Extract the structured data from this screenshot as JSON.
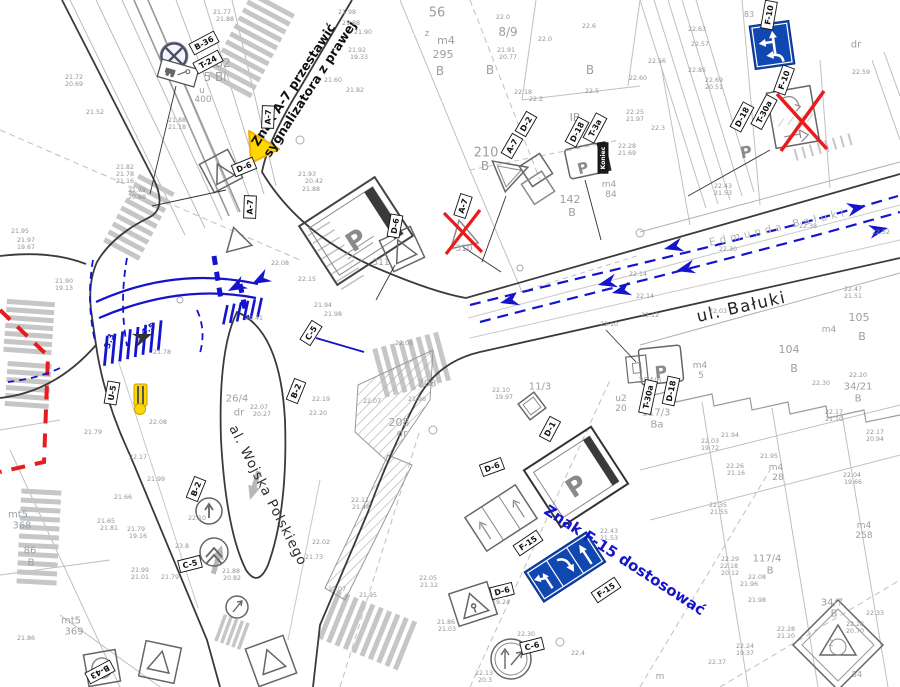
{
  "colors": {
    "marking_blue": "#1414cc",
    "sign_blue": "#1047b0",
    "alert_red": "#e81c1c",
    "temp_yellow": "#ffd800",
    "sketch_gray": "#666666",
    "cad_gray": "#b8b8b8",
    "text_gray": "#9aa0a6"
  },
  "streets": {
    "baluki": "ul. Bałuki",
    "edmunda_baluki": "Edmunda Bałuki",
    "wojska_polskiego": "al. Wojska Polskiego"
  },
  "instructions": {
    "a7_line1": "Znak A-7 przestawić",
    "a7_line2": "sygnalizatora z prawej",
    "f15": "Znak F-15 dostosować"
  },
  "sign_labels": [
    [
      204,
      43,
      "B-36",
      -28
    ],
    [
      208,
      62,
      "T-24",
      -28
    ],
    [
      268,
      117,
      "A-7",
      -88
    ],
    [
      244,
      167,
      "D-6",
      -22
    ],
    [
      250,
      207,
      "A-7",
      -88
    ],
    [
      463,
      206,
      "A-7",
      -72
    ],
    [
      512,
      146,
      "A-7",
      -60
    ],
    [
      526,
      124,
      "D-2",
      -60
    ],
    [
      577,
      132,
      "D-18",
      -62
    ],
    [
      595,
      128,
      "T-3a",
      -62
    ],
    [
      603,
      158,
      "Koniec",
      -90,
      true
    ],
    [
      742,
      117,
      "D-18",
      -62
    ],
    [
      764,
      112,
      "T-30a",
      -62
    ],
    [
      769,
      15,
      "F-10",
      -80
    ],
    [
      784,
      80,
      "F-10",
      -70
    ],
    [
      671,
      391,
      "D-18",
      -78
    ],
    [
      648,
      397,
      "T-30a",
      -78
    ],
    [
      550,
      429,
      "D-1",
      -62
    ],
    [
      395,
      226,
      "D-6",
      -80
    ],
    [
      311,
      333,
      "C-5",
      -58
    ],
    [
      296,
      391,
      "B-2",
      -68
    ],
    [
      196,
      489,
      "B-2",
      -68
    ],
    [
      190,
      564,
      "C-5",
      -14
    ],
    [
      112,
      393,
      "U-5",
      -80
    ],
    [
      492,
      467,
      "D-6",
      -20
    ],
    [
      502,
      591,
      "D-6",
      -14
    ],
    [
      532,
      646,
      "C-6",
      -14
    ],
    [
      528,
      543,
      "F-15",
      -34
    ],
    [
      606,
      590,
      "F-15",
      -34
    ],
    [
      100,
      672,
      "B-43",
      152
    ]
  ],
  "misc_labels": [
    [
      356,
      240,
      "P",
      -33,
      26,
      "#8a8a8a",
      true
    ],
    [
      576,
      486,
      "P",
      -33,
      26,
      "#8a8a8a",
      true
    ],
    [
      583,
      168,
      "P",
      -14,
      15,
      "#8a8a8a",
      true
    ],
    [
      661,
      372,
      "P",
      -6,
      17,
      "#8a8a8a",
      true
    ],
    [
      746,
      152,
      "P",
      -10,
      16,
      "#8a8a8a",
      true
    ],
    [
      109,
      341,
      "3.3",
      -70,
      8.5,
      "#1414cc",
      true
    ],
    [
      148,
      329,
      "4.5",
      -36,
      8.5,
      "#1414cc",
      true
    ]
  ],
  "parcel_labels": [
    [
      437,
      12,
      "56",
      13
    ],
    [
      427,
      33,
      "z",
      9
    ],
    [
      446,
      40,
      "m4",
      11
    ],
    [
      443,
      54,
      "295",
      11
    ],
    [
      440,
      71,
      "B",
      12
    ],
    [
      508,
      32,
      "8/9",
      12
    ],
    [
      490,
      70,
      "B",
      12
    ],
    [
      590,
      70,
      "B",
      12
    ],
    [
      223,
      63,
      "82",
      12
    ],
    [
      215,
      77,
      "5 Bi",
      12
    ],
    [
      202,
      90,
      "u",
      9
    ],
    [
      203,
      99,
      "400",
      9
    ],
    [
      575,
      117,
      "IB",
      11
    ],
    [
      486,
      152,
      "210",
      13
    ],
    [
      485,
      166,
      "B",
      12
    ],
    [
      570,
      199,
      "142",
      11
    ],
    [
      572,
      212,
      "B",
      11
    ],
    [
      609,
      184,
      "m4",
      9
    ],
    [
      611,
      194,
      "84",
      9
    ],
    [
      856,
      44,
      "dr",
      10
    ],
    [
      749,
      14,
      "83",
      8
    ],
    [
      464,
      248,
      "310",
      9
    ],
    [
      381,
      262,
      "311",
      9
    ],
    [
      427,
      383,
      "208",
      10
    ],
    [
      399,
      422,
      "208",
      11
    ],
    [
      402,
      433,
      "dr",
      10
    ],
    [
      540,
      386,
      "11/3",
      10
    ],
    [
      237,
      398,
      "26/4",
      10
    ],
    [
      239,
      412,
      "dr",
      10
    ],
    [
      789,
      349,
      "104",
      11
    ],
    [
      794,
      368,
      "B",
      11
    ],
    [
      700,
      365,
      "m4",
      9
    ],
    [
      701,
      375,
      "5",
      9
    ],
    [
      859,
      317,
      "105",
      11
    ],
    [
      829,
      329,
      "m4",
      9
    ],
    [
      862,
      336,
      "B",
      11
    ],
    [
      858,
      386,
      "34/21",
      10
    ],
    [
      858,
      398,
      "B",
      10
    ],
    [
      621,
      398,
      "u2",
      9
    ],
    [
      621,
      408,
      "20",
      9
    ],
    [
      656,
      412,
      "117/3",
      10
    ],
    [
      657,
      424,
      "Ba",
      10
    ],
    [
      650,
      380,
      "204/6",
      8
    ],
    [
      767,
      558,
      "117/4",
      10
    ],
    [
      770,
      570,
      "B",
      10
    ],
    [
      776,
      467,
      "m4",
      9
    ],
    [
      778,
      477,
      "28",
      9
    ],
    [
      864,
      525,
      "m4",
      9
    ],
    [
      864,
      535,
      "258",
      9
    ],
    [
      832,
      602,
      "34/7",
      10
    ],
    [
      834,
      613,
      "B",
      10
    ],
    [
      831,
      643,
      "2",
      9
    ],
    [
      857,
      674,
      "54",
      8
    ],
    [
      660,
      676,
      "m",
      9
    ],
    [
      18,
      514,
      "mt5",
      10
    ],
    [
      22,
      525,
      "368",
      10
    ],
    [
      30,
      550,
      "86",
      10
    ],
    [
      31,
      562,
      "B",
      10
    ],
    [
      71,
      620,
      "mt5",
      10
    ],
    [
      74,
      631,
      "369",
      10
    ]
  ],
  "elevation_labels": [
    [
      74,
      77,
      "21.72"
    ],
    [
      74,
      84,
      "20.69"
    ],
    [
      95,
      112,
      "21.52"
    ],
    [
      177,
      120,
      "21.88"
    ],
    [
      177,
      127,
      "21.18"
    ],
    [
      222,
      12,
      "21.77"
    ],
    [
      225,
      19,
      "21.88"
    ],
    [
      125,
      167,
      "21.82"
    ],
    [
      125,
      174,
      "21.78"
    ],
    [
      125,
      181,
      "21.16"
    ],
    [
      137,
      190,
      "21.79"
    ],
    [
      137,
      197,
      "20.88"
    ],
    [
      347,
      12,
      "21.98"
    ],
    [
      351,
      23,
      "21.88"
    ],
    [
      363,
      32,
      "21.90"
    ],
    [
      357,
      50,
      "21.92"
    ],
    [
      359,
      57,
      "19.33"
    ],
    [
      333,
      80,
      "21.60"
    ],
    [
      355,
      90,
      "21.82"
    ],
    [
      503,
      17,
      "22.0"
    ],
    [
      589,
      26,
      "22.6"
    ],
    [
      545,
      39,
      "22.0"
    ],
    [
      506,
      50,
      "21.91"
    ],
    [
      508,
      57,
      "20.77"
    ],
    [
      523,
      92,
      "22.18"
    ],
    [
      536,
      99,
      "22.2"
    ],
    [
      592,
      91,
      "22.5"
    ],
    [
      307,
      174,
      "21.93"
    ],
    [
      314,
      181,
      "20.42"
    ],
    [
      311,
      189,
      "21.88"
    ],
    [
      697,
      29,
      "22.63"
    ],
    [
      700,
      44,
      "22.57"
    ],
    [
      657,
      61,
      "22.56"
    ],
    [
      697,
      70,
      "22.85"
    ],
    [
      638,
      78,
      "22.60"
    ],
    [
      714,
      80,
      "22.69"
    ],
    [
      714,
      87,
      "20.51"
    ],
    [
      861,
      72,
      "22.59"
    ],
    [
      635,
      112,
      "22.25"
    ],
    [
      635,
      119,
      "21.97"
    ],
    [
      658,
      128,
      "22.3"
    ],
    [
      627,
      146,
      "22.28"
    ],
    [
      627,
      153,
      "21.69"
    ],
    [
      723,
      186,
      "22.43"
    ],
    [
      723,
      193,
      "21.53"
    ],
    [
      20,
      231,
      "21.95"
    ],
    [
      26,
      240,
      "21.97"
    ],
    [
      26,
      247,
      "19.67"
    ],
    [
      64,
      281,
      "21.90"
    ],
    [
      64,
      288,
      "19.13"
    ],
    [
      280,
      263,
      "22.08"
    ],
    [
      254,
      318,
      "20.41"
    ],
    [
      162,
      352,
      "21.78"
    ],
    [
      158,
      422,
      "22.08"
    ],
    [
      93,
      432,
      "21.79"
    ],
    [
      259,
      407,
      "22.07"
    ],
    [
      262,
      414,
      "20.27"
    ],
    [
      307,
      279,
      "22.15"
    ],
    [
      323,
      305,
      "21.94"
    ],
    [
      333,
      314,
      "21.98"
    ],
    [
      404,
      343,
      "22.08"
    ],
    [
      321,
      399,
      "22.19"
    ],
    [
      372,
      401,
      "22.07"
    ],
    [
      318,
      413,
      "22.20"
    ],
    [
      417,
      399,
      "21.96"
    ],
    [
      501,
      390,
      "22.10"
    ],
    [
      504,
      397,
      "19.97"
    ],
    [
      881,
      232,
      "22.52"
    ],
    [
      808,
      226,
      "22.38"
    ],
    [
      728,
      249,
      "22.30"
    ],
    [
      638,
      274,
      "22.14"
    ],
    [
      645,
      296,
      "22.14"
    ],
    [
      853,
      289,
      "22.47"
    ],
    [
      853,
      296,
      "21.51"
    ],
    [
      650,
      315,
      "22.12"
    ],
    [
      718,
      311,
      "22.03"
    ],
    [
      609,
      324,
      "22.10"
    ],
    [
      858,
      375,
      "22.20"
    ],
    [
      821,
      383,
      "22.30"
    ],
    [
      834,
      412,
      "22.17"
    ],
    [
      834,
      419,
      "21.10"
    ],
    [
      875,
      432,
      "22.17"
    ],
    [
      875,
      439,
      "20.94"
    ],
    [
      730,
      435,
      "21.94"
    ],
    [
      710,
      441,
      "22.03"
    ],
    [
      710,
      448,
      "19.72"
    ],
    [
      138,
      457,
      "22.17"
    ],
    [
      156,
      479,
      "21.99"
    ],
    [
      123,
      497,
      "21.66"
    ],
    [
      106,
      521,
      "21.65"
    ],
    [
      109,
      528,
      "21.81"
    ],
    [
      136,
      529,
      "21.79"
    ],
    [
      138,
      536,
      "19.16"
    ],
    [
      140,
      570,
      "21.99"
    ],
    [
      140,
      577,
      "21.01"
    ],
    [
      170,
      577,
      "21.79"
    ],
    [
      182,
      546,
      "23.8"
    ],
    [
      197,
      518,
      "22.10"
    ],
    [
      231,
      571,
      "21.88"
    ],
    [
      232,
      578,
      "20.82"
    ],
    [
      26,
      638,
      "21.86"
    ],
    [
      360,
      500,
      "22.11"
    ],
    [
      361,
      507,
      "21.48"
    ],
    [
      321,
      542,
      "22.02"
    ],
    [
      314,
      557,
      "21.73"
    ],
    [
      337,
      589,
      "22.07"
    ],
    [
      368,
      595,
      "21.95"
    ],
    [
      428,
      578,
      "22.05"
    ],
    [
      429,
      585,
      "21.12"
    ],
    [
      446,
      622,
      "21.86"
    ],
    [
      447,
      629,
      "21.03"
    ],
    [
      526,
      634,
      "22.30"
    ],
    [
      500,
      595,
      "22.28"
    ],
    [
      501,
      602,
      "19.24"
    ],
    [
      484,
      673,
      "22.13"
    ],
    [
      485,
      680,
      "20.3"
    ],
    [
      578,
      653,
      "22.4"
    ],
    [
      735,
      466,
      "22.26"
    ],
    [
      736,
      473,
      "21.16"
    ],
    [
      718,
      505,
      "22.35"
    ],
    [
      719,
      512,
      "21.55"
    ],
    [
      609,
      531,
      "22.43"
    ],
    [
      609,
      538,
      "21.53"
    ],
    [
      852,
      475,
      "22.04"
    ],
    [
      853,
      482,
      "19.66"
    ],
    [
      730,
      559,
      "22.29"
    ],
    [
      729,
      566,
      "22.18"
    ],
    [
      730,
      573,
      "20.12"
    ],
    [
      757,
      577,
      "22.08"
    ],
    [
      749,
      584,
      "21.96"
    ],
    [
      757,
      600,
      "21.98"
    ],
    [
      786,
      629,
      "22.28"
    ],
    [
      786,
      636,
      "21.20"
    ],
    [
      875,
      613,
      "22.33"
    ],
    [
      855,
      624,
      "22.28"
    ],
    [
      855,
      631,
      "20.70"
    ],
    [
      745,
      646,
      "22.24"
    ],
    [
      745,
      653,
      "19.37"
    ],
    [
      717,
      662,
      "22.37"
    ],
    [
      769,
      456,
      "21.95"
    ]
  ]
}
